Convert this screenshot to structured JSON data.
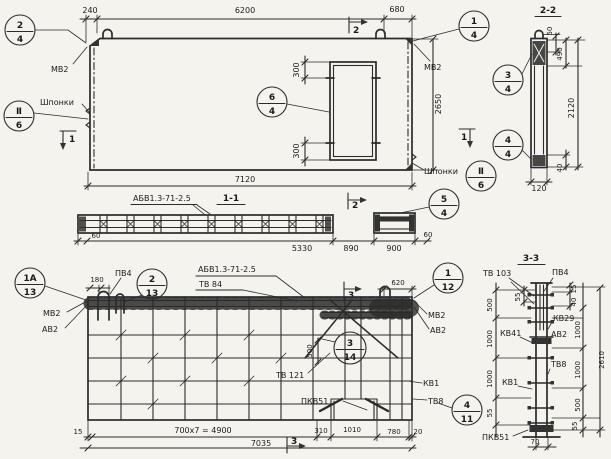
{
  "markers": {
    "m1": "1",
    "m2": "2",
    "m3": "3"
  },
  "callouts": [
    {
      "id": "plan-top-left",
      "num": "2",
      "den": "4"
    },
    {
      "id": "plan-top-right",
      "num": "1",
      "den": "4"
    },
    {
      "id": "plan-opening",
      "num": "6",
      "den": "4"
    },
    {
      "id": "plan-keys-left",
      "num": "Ⅱ",
      "den": "6"
    },
    {
      "id": "plan-keys-right",
      "num": "Ⅱ",
      "den": "6"
    },
    {
      "id": "sec22-top-detail",
      "num": "3",
      "den": "4"
    },
    {
      "id": "sec22-bottom-detail",
      "num": "4",
      "den": "4"
    },
    {
      "id": "sec11-end-detail",
      "num": "5",
      "den": "4"
    },
    {
      "id": "elev-top-left",
      "num": "1А",
      "den": "13"
    },
    {
      "id": "elev-top",
      "num": "2",
      "den": "13"
    },
    {
      "id": "elev-center",
      "num": "3",
      "den": "14"
    },
    {
      "id": "elev-top-right",
      "num": "1",
      "den": "12"
    },
    {
      "id": "elev-bottom-right",
      "num": "4",
      "den": "11"
    }
  ],
  "plan": {
    "dims": {
      "edge_left": "240",
      "top_span": "6200",
      "edge_right": "680",
      "height": "2650",
      "opening_top": "300",
      "opening_bottom": "300",
      "total_width": "7120"
    },
    "labels": {
      "mv2_left": "МВ2",
      "mv2_right": "МВ2",
      "keys_left": "Шпонки",
      "keys_right": "Шпонки"
    }
  },
  "sec11": {
    "title": "1-1",
    "mark": "АБВ1.3-71-2.5",
    "dims": {
      "d60_left": "60",
      "d5330": "5330",
      "d890": "890",
      "d900": "900",
      "d60_right": "60"
    }
  },
  "sec22": {
    "title": "2-2",
    "dims": {
      "d50": "50",
      "d490": "490",
      "d2120": "2120",
      "d40": "40",
      "d120": "120"
    }
  },
  "elev": {
    "mark_top": "АБВ1.3-71-2.5",
    "mark_bottom": "ТВ 84",
    "labels": {
      "pv4": "ПВ4",
      "mv2_left": "МВ2",
      "av2_left": "АВ2",
      "mv2_right": "МВ2",
      "av2_right": "АВ2",
      "tv121": "ТВ 121",
      "kv1": "КВ1",
      "pkv51": "ПКВ51",
      "tv8": "ТВ8"
    },
    "dims": {
      "d180": "180",
      "d620": "620",
      "d500": "500",
      "d15": "15",
      "spacing": "700x7 = 4900",
      "d310": "310",
      "d1010": "1010",
      "d780": "780",
      "d20": "20",
      "total": "7035"
    }
  },
  "sec33": {
    "title": "3-3",
    "labels": {
      "tv103": "ТВ 103",
      "pv4": "ПВ4",
      "kv29": "КВ29",
      "av2": "АВ2",
      "kv41": "КВ41",
      "kv1": "КВ1",
      "tv8": "ТВ8",
      "pkv51": "ПКВ51"
    },
    "dims_left": {
      "d55_top": "55",
      "d500": "500",
      "d1000_a": "1000",
      "d1000_b": "1000",
      "d55_bottom": "55"
    },
    "dims_right": {
      "d15": "15",
      "d40": "40",
      "d1000_a": "1000",
      "d1000_b": "1000",
      "d500": "500",
      "d55": "55",
      "total": "2610"
    },
    "dims_bottom": {
      "d70": "70"
    }
  }
}
